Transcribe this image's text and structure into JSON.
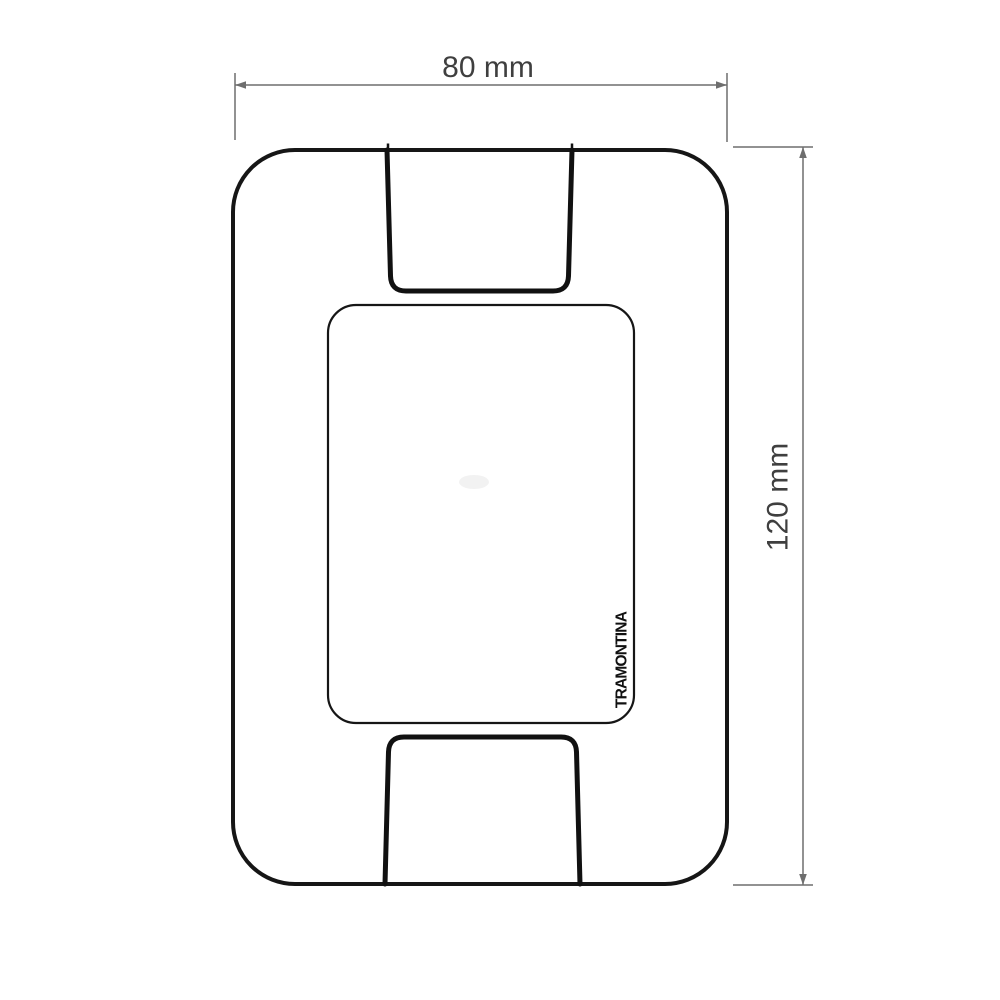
{
  "dimensions": {
    "width_label": "80 mm",
    "height_label": "120 mm"
  },
  "brand": {
    "label": "TRAMONTINA"
  },
  "colors": {
    "background": "#ffffff",
    "outline": "#161616",
    "cutout_outline": "#111111",
    "dimension_line": "#6e6e6e",
    "dimension_text": "#3f3f3f",
    "brand_text": "#111111"
  }
}
